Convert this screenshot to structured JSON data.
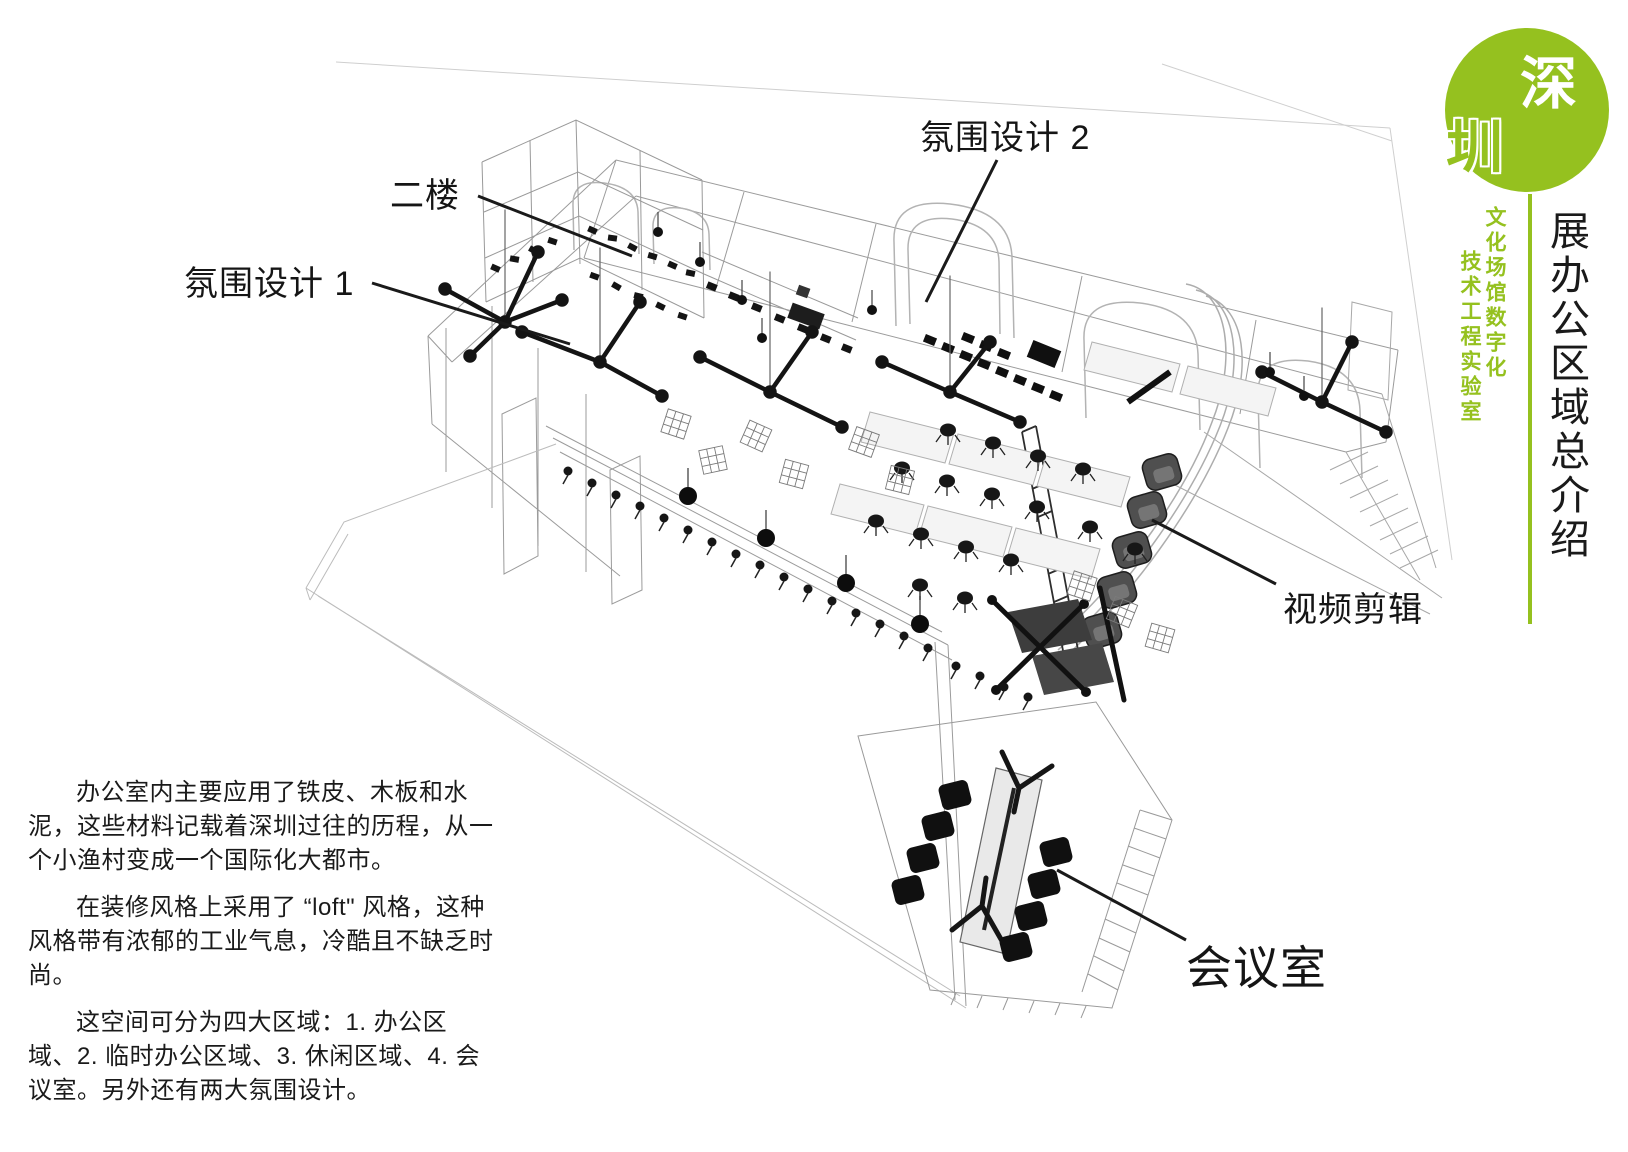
{
  "slide": {
    "background": "#ffffff"
  },
  "brand": {
    "green": "#95c11f",
    "logo_top_char": "深",
    "logo_bottom_char": "圳",
    "tagline_right_column": "文化场馆数字化",
    "tagline_left_column": "技术工程实验室",
    "vertical_title": "展办公区域总介绍"
  },
  "diagram": {
    "labels": [
      {
        "id": "second-floor",
        "text": "二楼"
      },
      {
        "id": "atmosphere-1",
        "text": "氛围设计 1"
      },
      {
        "id": "atmosphere-2",
        "text": "氛围设计 2"
      },
      {
        "id": "video-editing",
        "text": "视频剪辑"
      },
      {
        "id": "meeting-room",
        "text": "会议室"
      }
    ]
  },
  "description": {
    "paragraphs": [
      "办公室内主要应用了铁皮、木板和水泥，这些材料记载着深圳过往的历程，从一个小渔村变成一个国际化大都市。",
      "在装修风格上采用了 “loft\" 风格，这种风格带有浓郁的工业气息，冷酷且不缺乏时尚。",
      "这空间可分为四大区域：1. 办公区域、2. 临时办公区域、3. 休闲区域、4. 会议室。另外还有两大氛围设计。"
    ]
  }
}
